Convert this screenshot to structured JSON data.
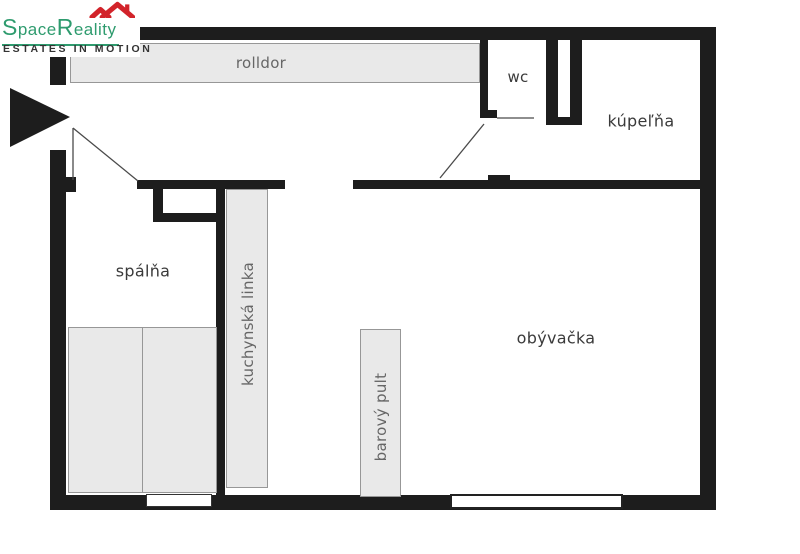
{
  "logo": {
    "brand": {
      "part1": "S",
      "part2": "pace",
      "part3": "R",
      "part4": "eality"
    },
    "tagline": "ESTATES IN MOTION"
  },
  "rooms": {
    "bedroom": {
      "label": "spálňa"
    },
    "living_room": {
      "label": "obývačka"
    },
    "bathroom": {
      "label": "kúpeľňa"
    },
    "wc": {
      "label": "wc"
    }
  },
  "furniture": {
    "roller_wardrobe": {
      "label": "rolldor"
    },
    "kitchen_unit": {
      "label": "kuchynská linka"
    },
    "bar_counter": {
      "label": "barový pult"
    }
  },
  "colors": {
    "wall": "#1D1D1D",
    "furniture_fill": "#E9E9E9",
    "furniture_border": "#979797",
    "logo_green": "#2E9B6E",
    "logo_red": "#D2232A",
    "room_label": "#3A3A3A",
    "furniture_label": "#666666"
  }
}
